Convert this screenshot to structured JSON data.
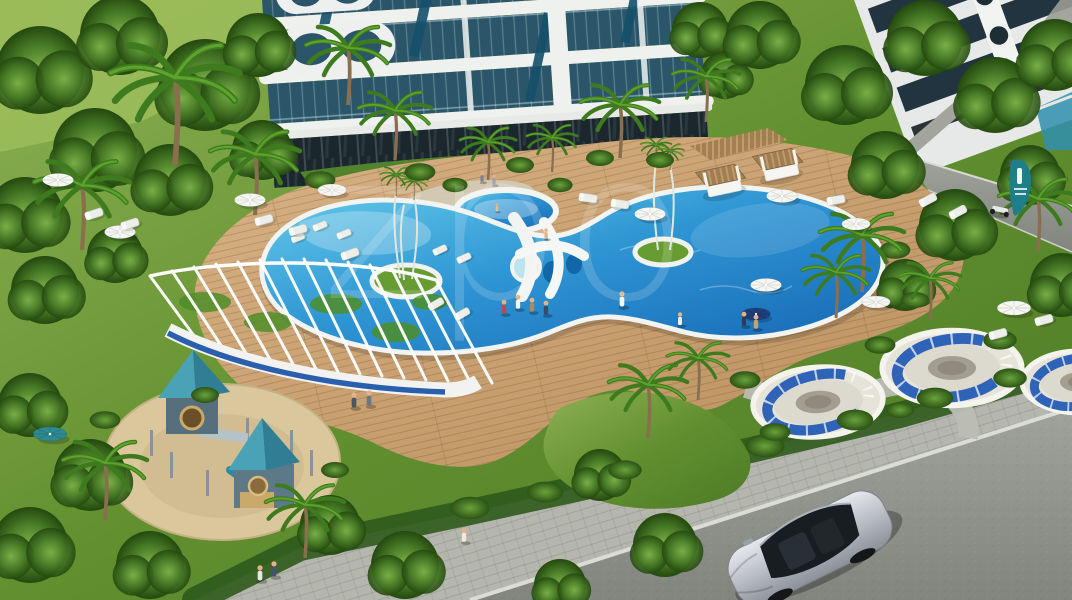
{
  "scene_type": "aerial 3D architectural rendering of a residential complex with pool garden",
  "watermark": {
    "text": "zpo"
  },
  "colors": {
    "grass": "#6b9a38",
    "grass_light": "#9dbd5a",
    "foliage_dark": "#2a5517",
    "pool_water": "#2f96d4",
    "pool_shallow": "#68cdea",
    "pool_rim": "#f2f4f1",
    "deck_wood": "#c9a06c",
    "sand": "#dbc79c",
    "building_white": "#eef1ee",
    "building_glass": "#2b5669",
    "roof_teal": "#3d93a8",
    "cushion_blue": "#2f63b8",
    "stripe_blue": "#2a5fae",
    "road": "#94968f",
    "sidewalk": "#b5b6ae",
    "car_silver": "#c3c6cb",
    "sign_teal": "#1e7f8a",
    "canopy_white": "#f6f6f2"
  }
}
